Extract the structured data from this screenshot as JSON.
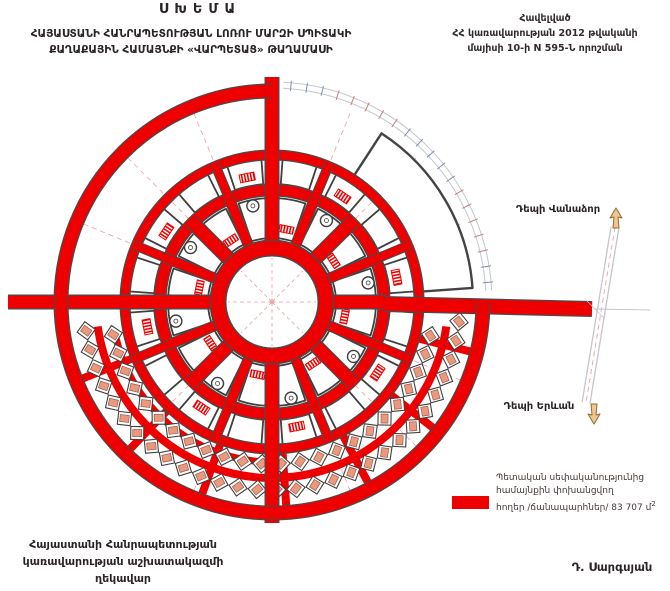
{
  "header": {
    "title": "ՍԽԵՄԱ",
    "subtitle_line1": "ՀԱՅԱՍՏԱՆԻ ՀԱՆՐԱՊԵՏՈՒԹՅԱՆ ԼՈՌՈՒ ՄԱՐԶԻ ՍՊԻՏԱԿԻ",
    "subtitle_line2": "ՔԱՂԱՔԱՅԻՆ ՀԱՄԱՅՆՔԻ «ՎԱՐՊԵՏԱՑ» ԹԱՂԱՄԱՍԻ"
  },
  "annex": {
    "line1": "Հավելված",
    "line2": "ՀՀ կառավարության 2012 թվականի",
    "line3": "մայիսի 10-ի N 595-Ն որոշման"
  },
  "map": {
    "label_to_vanadzor": "Դեպի Վանաձոր",
    "label_to_yerevan": "Դեպի Երևան",
    "icons": [
      "up-direction-arrow-icon",
      "down-direction-arrow-icon"
    ],
    "colors": {
      "road": "#ee0000",
      "road_edge": "#4a4a4a",
      "block_outline": "#3f3f3f",
      "house_fill": "#e9997d",
      "house_stroke": "#9c5a48",
      "guide": "#e8a3a3",
      "boundary": "#c2c6cd",
      "arrow_fill": "#f2c78f",
      "arrow_stroke": "#8d6a33"
    }
  },
  "legend": {
    "line1": "Պետական սեփականությունից",
    "line2": "համայնքին փոխանցվող",
    "line3": "հողեր /ճանապարհներ/ 83 707 մ",
    "superscript": "2",
    "swatch_color": "#ee0000"
  },
  "footer": {
    "left_line1": "Հայաստանի Հանրապետության",
    "left_line2": "կառավարության աշխատակազմի",
    "left_line3": "ղեկավար",
    "signer": "Դ. Սարգսյան"
  }
}
